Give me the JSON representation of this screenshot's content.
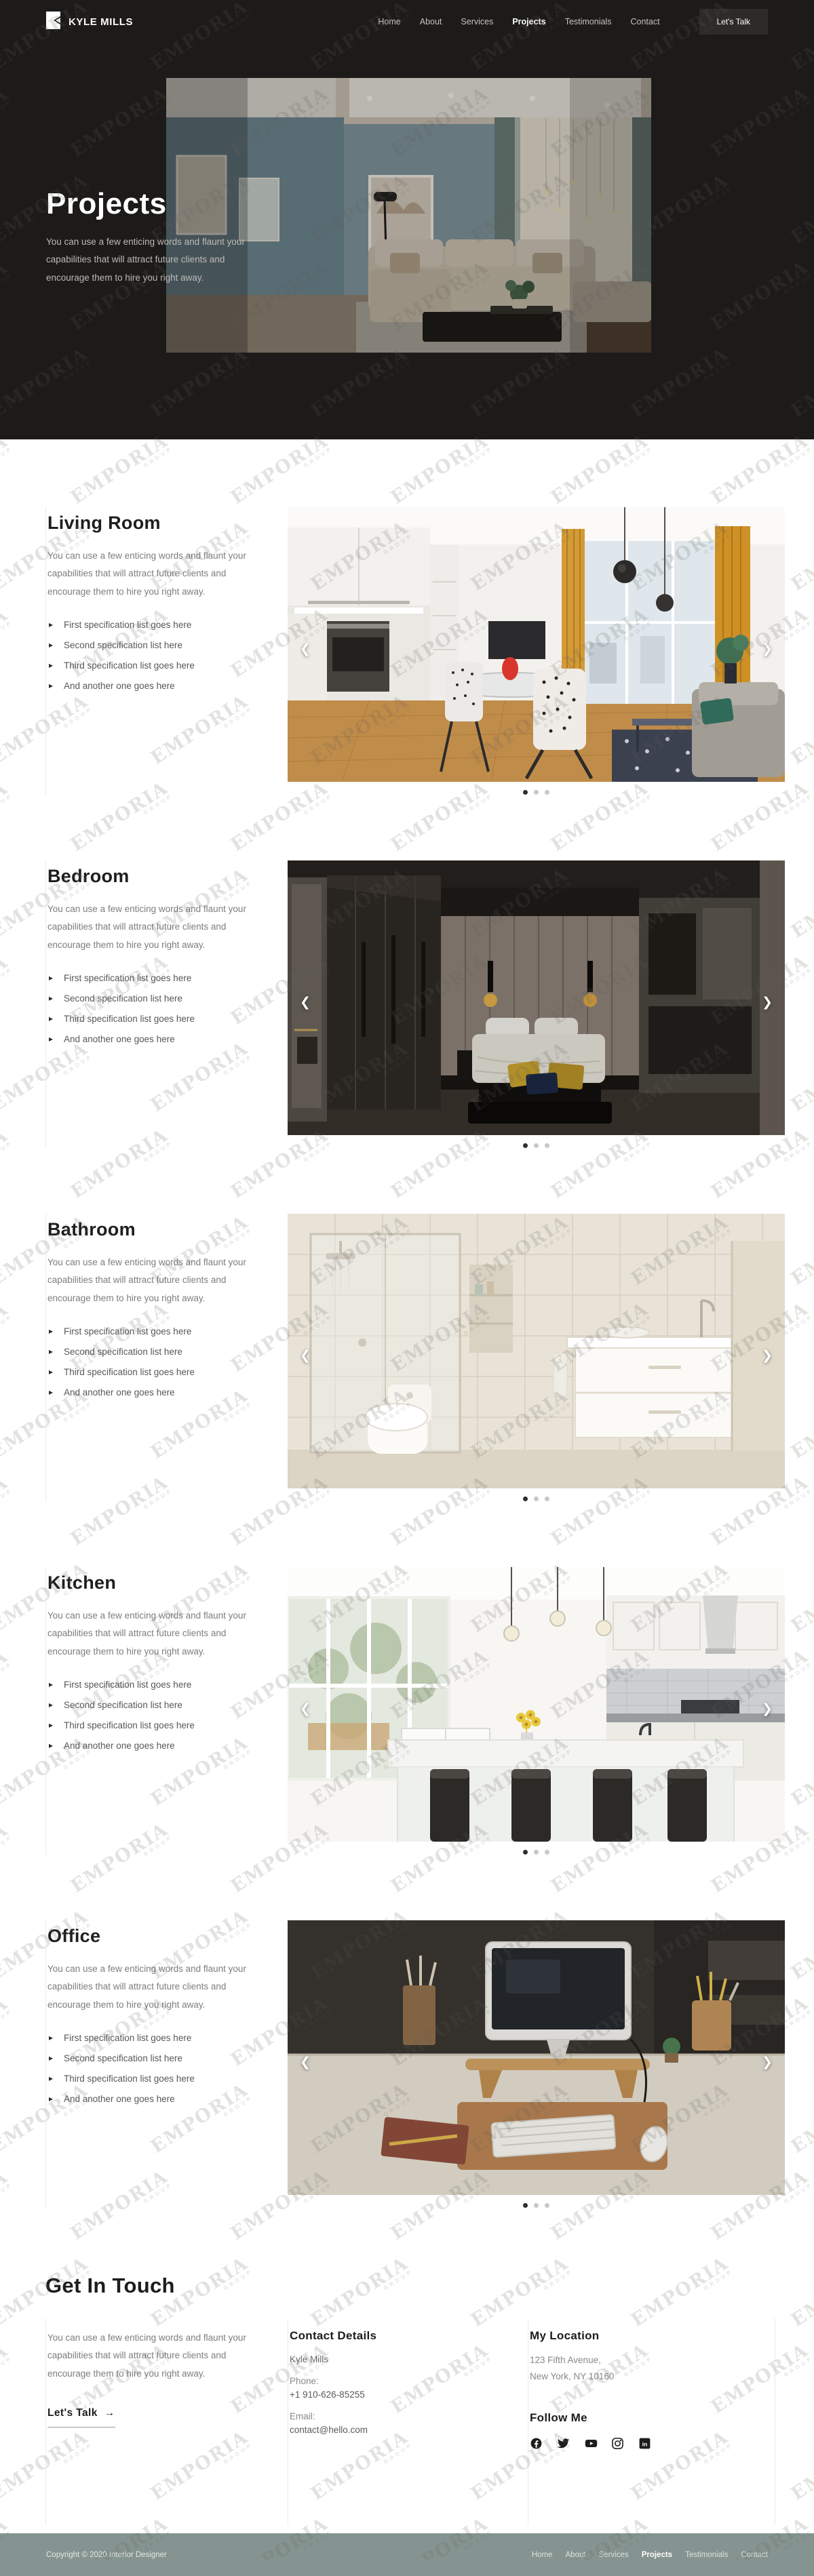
{
  "header": {
    "brand": "KYLE MILLS",
    "nav": [
      "Home",
      "About",
      "Services",
      "Projects",
      "Testimonials",
      "Contact"
    ],
    "active_nav": "Projects",
    "cta": "Let's Talk"
  },
  "hero": {
    "title": "Projects",
    "description": "You can use a few enticing words and flaunt your capabilities that will attract future clients and encourage them to hire you right away."
  },
  "shared": {
    "section_description": "You can use a few enticing words and flaunt your capabilities that will attract future clients and encourage them to hire you right away.",
    "specs": [
      "First specification list goes here",
      "Second specification list here",
      "Third specification list goes here",
      "And another one goes here"
    ]
  },
  "sections": [
    {
      "title": "Living Room",
      "photo": "living-room-photo"
    },
    {
      "title": "Bedroom",
      "photo": "bedroom-photo"
    },
    {
      "title": "Bathroom",
      "photo": "bathroom-photo"
    },
    {
      "title": "Kitchen",
      "photo": "kitchen-photo"
    },
    {
      "title": "Office",
      "photo": "office-photo"
    }
  ],
  "carousel": {
    "prev_glyph": "❮",
    "next_glyph": "❯",
    "dot_count": 3
  },
  "contact": {
    "heading": "Get In Touch",
    "description": "You can use a few enticing words and flaunt your capabilities that will attract future clients and encourage them to hire you right away.",
    "cta": "Let's Talk",
    "cta_arrow": "→",
    "details": {
      "heading": "Contact Details",
      "name": "Kyle Mills",
      "phone_label": "Phone:",
      "phone": "+1 910-626-85255",
      "email_label": "Email:",
      "email": "contact@hello.com"
    },
    "location": {
      "heading": "My Location",
      "address_line1": "123 Fifth Avenue,",
      "address_line2": "New York, NY 10160"
    },
    "follow": {
      "heading": "Follow Me",
      "platforms": [
        "facebook",
        "twitter",
        "youtube",
        "instagram",
        "linkedin"
      ]
    }
  },
  "footer": {
    "copyright": "Copyright © 2020 Interior Designer",
    "links": [
      "Home",
      "About",
      "Services",
      "Projects",
      "Testimonials",
      "Contact"
    ],
    "active_link": "Projects"
  },
  "watermark": {
    "text": "EMPORIA",
    "subtext": "GROUP"
  },
  "colors": {
    "dark": "#1d1b19",
    "footer": "#859490",
    "accent_gold": "#d39a36"
  }
}
